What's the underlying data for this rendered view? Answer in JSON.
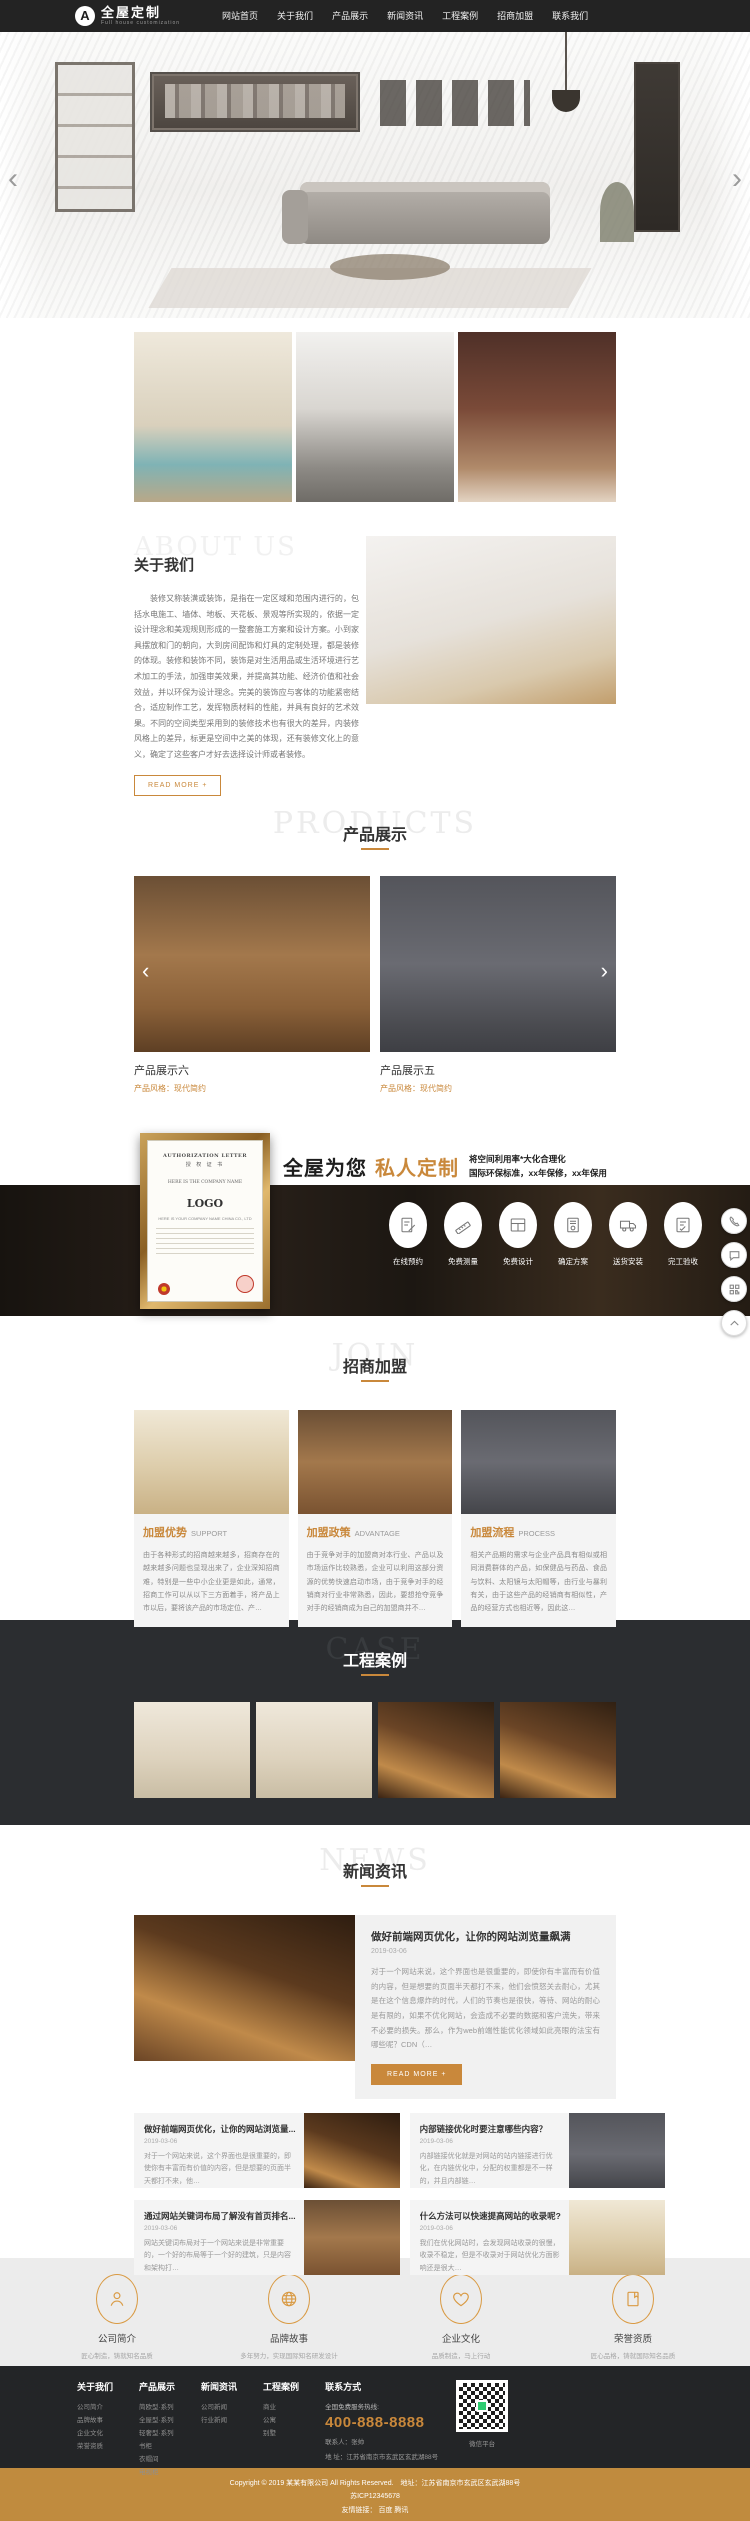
{
  "colors": {
    "accent": "#c9883b",
    "dark": "#232323",
    "gold_bar": "#c08b3e"
  },
  "header": {
    "logo_badge": "A",
    "logo_text": "全屋定制",
    "logo_sub": "Full house customization",
    "nav": [
      "网站首页",
      "关于我们",
      "产品展示",
      "新闻资讯",
      "工程案例",
      "招商加盟",
      "联系我们"
    ]
  },
  "banner": {
    "prev": "‹",
    "next": "›"
  },
  "about": {
    "watermark": "ABOUT US",
    "title": "关于我们",
    "paragraph": "装修又称装潢或装饰，是指在一定区域和范围内进行的，包括水电施工、墙体、地板、天花板、景观等所实现的，依据一定设计理念和美观规则形成的一整套施工方案和设计方案。小到家具摆放和门的朝向，大到房间配饰和灯具的定制处理，都是装修的体现。装修和装饰不同，装饰是对生活用品或生活环境进行艺术加工的手法，加强审美效果，并提高其功能、经济价值和社会效益，并以环保为设计理念。完美的装饰应与客体的功能紧密结合，适应制作工艺，发挥物质材料的性能，并具有良好的艺术效果。不同的空间类型采用到的装修技术也有很大的差异，内装修风格上的差异，标更是空间中之美的体现，还有装修文化上的意义，确定了这些客户才好去选择设计师或者装修。",
    "read_more": "READ MORE +"
  },
  "products": {
    "watermark": "PRODUCTS",
    "title": "产品展示",
    "prev": "‹",
    "next": "›",
    "items": [
      {
        "name": "产品展示六",
        "style": "产品风格：现代简约",
        "highlight": "产品亮点：产品采用整体橱柜兼顾了原木本来，匠心(随意地)搭配不同的颜色、特点。"
      },
      {
        "name": "产品展示五",
        "style": "产品风格：现代简约",
        "highlight": "产品亮点：产品采用整体橱柜兼顾了原木本来，匠心(随意地)搭配不同的颜色、特点。"
      }
    ]
  },
  "custom": {
    "title_black": "全屋为您",
    "title_orange": "私人定制",
    "line1": "将空间利用率*大化合理化",
    "line2": "国际环保标准，xx年保修，xx年保用",
    "certificate": {
      "header": "AUTHORIZATION LETTER",
      "sub": "授 权 证 书",
      "company": "HERE IS THE COMPANY NAME",
      "logo": "LOGO",
      "footer_line": "HERE IS YOUR COMPANY NAME CHINA CO., LTD"
    },
    "steps": [
      {
        "icon": "form-icon",
        "label": "在线预约"
      },
      {
        "icon": "ruler-icon",
        "label": "免费测量"
      },
      {
        "icon": "design-icon",
        "label": "免费设计"
      },
      {
        "icon": "plan-icon",
        "label": "确定方案"
      },
      {
        "icon": "truck-icon",
        "label": "送货安装"
      },
      {
        "icon": "checklist-icon",
        "label": "完工验收"
      }
    ]
  },
  "join": {
    "watermark": "JOIN",
    "title": "招商加盟",
    "cards": [
      {
        "title": "加盟优势",
        "subtitle": "SUPPORT",
        "text": "由于各种形式的招商越来越多，招商存在的越来越多问题也显现出来了，企业深知招商难，特别是一些中小企业更是如此，通常，招商工作可以从以下三方面着手，将产品上市以后，要将该产品的市场定位、产…"
      },
      {
        "title": "加盟政策",
        "subtitle": "ADVANTAGE",
        "text": "由于竞争对手的加盟商对本行业、产品以及市场运作比较熟悉，企业可以利用这部分资源的优势快速启动市场，由于竞争对手的经销商对行业非常熟悉，因此，要想抢夺竞争对手的经销商成为自己的加盟商并不…"
      },
      {
        "title": "加盟流程",
        "subtitle": "PROCESS",
        "text": "相关产品期的需求与企业产品具有相似或相同消费群体的产品，如保健品与药品、食品与饮料、太阳镜与太阳帽等，由行业与暴利有关，由于这些产品的经销商有相似性，产品的经营方式也相近等，因此这…"
      }
    ]
  },
  "cases": {
    "watermark": "CASE",
    "title": "工程案例"
  },
  "news": {
    "watermark": "NEWS",
    "title": "新闻资讯",
    "featured": {
      "title": "做好前端网页优化，让你的网站浏览量飙满",
      "date": "2019-03-06",
      "text": "对于一个网站来说，这个界面也是很重要的，即使你有丰富而有价值的内容，但是想要的页面半天都打不来，他们会愤怒关去耐心，尤其是在这个信息爆炸的时代，人们的节奏也是很快，等待、网站的耐心是有限的，如果不优化网站，会造成不必要的数据和客户流失，带来不必要的损失。那么，作为web前端性能优化领域如此亮眼的法宝有哪些呢？CDN（…",
      "read_more": "READ MORE +"
    },
    "items": [
      {
        "title": "做好前端网页优化，让你的网站浏览量...",
        "date": "2019-03-06",
        "text": "对于一个网站来说，这个界面也是很重要的，即使你有丰富而有价值的内容，但是想要的页面半天都打不来，他…"
      },
      {
        "title": "内部链接优化时要注意哪些内容？",
        "date": "2019-03-06",
        "text": "内部链接优化就是对网站的站内链接进行优化，在内链优化中，分配的权重都是不一样的，并且内部链…"
      },
      {
        "title": "通过网站关键词布局了解没有首页排名...",
        "date": "2019-03-06",
        "text": "网站关键词布局对于一个网站来说是非常重要的，一个好的布局等于一个好的建筑，只是内容和架构打…"
      },
      {
        "title": "什么方法可以快速提高网站的收录呢?",
        "date": "2019-03-06",
        "text": "我们在优化网站时，会发现网站收录的很慢，收录不稳定，但是不收录对于网站优化方面影响还是很大…"
      }
    ]
  },
  "features": [
    {
      "icon": "person-icon",
      "title": "公司简介",
      "subtitle": "匠心制造，铸就知名品质"
    },
    {
      "icon": "globe-icon",
      "title": "品牌故事",
      "subtitle": "多年努力，实现国际知名研发设计"
    },
    {
      "icon": "heart-icon",
      "title": "企业文化",
      "subtitle": "品质制造，马上行动"
    },
    {
      "icon": "badge-icon",
      "title": "荣誉资质",
      "subtitle": "匠心品格，铸就国际知名品质"
    }
  ],
  "footer": {
    "columns": [
      {
        "title": "关于我们",
        "links": [
          "公司简介",
          "品牌故事",
          "企业文化",
          "荣誉资质"
        ]
      },
      {
        "title": "产品展示",
        "links": [
          "简欧型·系列",
          "全屋型·系列",
          "轻奢型·系列",
          "书柜",
          "衣帽间",
          "电视柜"
        ]
      },
      {
        "title": "新闻资讯",
        "links": [
          "公司新闻",
          "行业新闻"
        ]
      },
      {
        "title": "工程案例",
        "links": [
          "商业",
          "公寓",
          "别墅"
        ]
      }
    ],
    "contact": {
      "title": "联系方式",
      "hotline_label": "全国免费服务热线:",
      "hotline": "400-888-8888",
      "person": "联系人：张帅",
      "address": "地 址：江苏省南京市玄武区玄武湖88号"
    },
    "qr_caption": "微信平台",
    "copyright": "Copyright © 2019 某某有限公司 All Rights Reserved.　地址：江苏省南京市玄武区玄武湖88号",
    "icp": "苏ICP12345678",
    "links_line": "友情链接： 百度 腾讯"
  }
}
